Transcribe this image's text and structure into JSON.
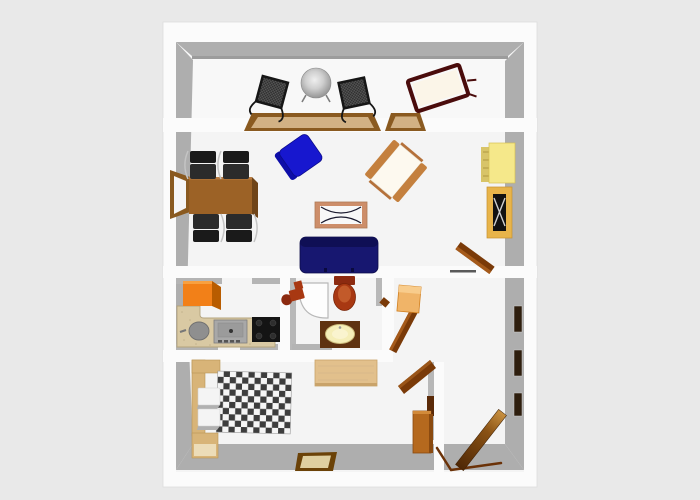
{
  "page": {
    "kind": "3d-apartment-floor-plan-render",
    "background": "#e9e9e9"
  },
  "palette": {
    "background": "#e9e9e9",
    "wallWhite": "#fbfbfb",
    "wallGray": "#aeaeae",
    "wallGrayDark": "#9c9c9c",
    "floor": "#f4f4f4",
    "balconyFloor": "#f8f8f8",
    "frameBrown": "#8a5a20",
    "glassTan": "#d2b184",
    "chairBlack": "#1a1a1a",
    "loungerFrame": "#4a0c0c",
    "loungerCushion": "#fbf5e8",
    "diningBrown": "#9c6226",
    "diningBrownDark": "#6f4418",
    "blueChair": "#1717cf",
    "blueChairDark": "#0d0da8",
    "cushionWhite": "#fdf9ef",
    "armWood": "#c4803e",
    "coffeeFrame": "#cd8e6a",
    "coffeeTop": "#f8f8f8",
    "sofaNavy": "#171770",
    "sofaNavyDark": "#0f0f55",
    "cabinetYellow": "#f5e88a",
    "cabinetYellowSide": "#d8c468",
    "tvOrange": "#e8b44a",
    "tvBlack": "#111111",
    "doorBrown": "#7a3a08",
    "doorLight": "#a55a1a",
    "fridgeOrange": "#f28018",
    "fridgeSide": "#b85c00",
    "counterBeige": "#d9c9a3",
    "sinkGray": "#8f8f8f",
    "applianceGray": "#a8a8a8",
    "cooktopBlack": "#141414",
    "toiletRed": "#a83812",
    "toiletRedDark": "#8c2a10",
    "vanityBrown": "#5f3210",
    "basinCream": "#f5eeb8",
    "showerWhite": "#fdfdfd",
    "hallCabinetTan": "#f0b468",
    "hallCabinetTop": "#f8cc8c",
    "panelDark": "#2e1e0e",
    "bedWood": "#d8b478",
    "nightstandFront": "#ecdcb8",
    "pillowWhite": "#f4f4f4",
    "pillowShadow": "#b0b0b0",
    "blanketDark": "#3d3d3d",
    "blanketLight": "#f5f5f5",
    "deskWood": "#e2c08c",
    "closetBrown": "#b5691e",
    "pictureFrame": "#6b4208",
    "pictureInner": "#dfcfa0"
  },
  "rooms": [
    {
      "name": "balcony",
      "furniture": [
        "folding-chair",
        "round-metal-table",
        "folding-chair",
        "sun-lounger"
      ]
    },
    {
      "name": "living-room",
      "furniture": [
        "wall-window",
        "dining-table",
        "black-chair",
        "black-chair",
        "black-chair",
        "black-chair",
        "blue-armchair",
        "wooden-armchair",
        "coffee-table",
        "sofa",
        "yellow-cabinet",
        "tv-shelf",
        "open-door"
      ]
    },
    {
      "name": "kitchen",
      "furniture": [
        "refrigerator",
        "l-counter",
        "round-sink",
        "appliance",
        "cooktop"
      ]
    },
    {
      "name": "bathroom",
      "furniture": [
        "wash-fixture",
        "corner-shower",
        "toilet",
        "vanity-sink",
        "open-door"
      ]
    },
    {
      "name": "hallway",
      "furniture": [
        "shoe-cabinet",
        "wall-panel",
        "wall-panel",
        "wall-panel",
        "entry-door"
      ]
    },
    {
      "name": "bedroom",
      "furniture": [
        "bed-headboard",
        "pillow",
        "pillow",
        "checkered-blanket",
        "nightstand",
        "desk",
        "closet",
        "open-door",
        "wall-picture"
      ]
    }
  ]
}
